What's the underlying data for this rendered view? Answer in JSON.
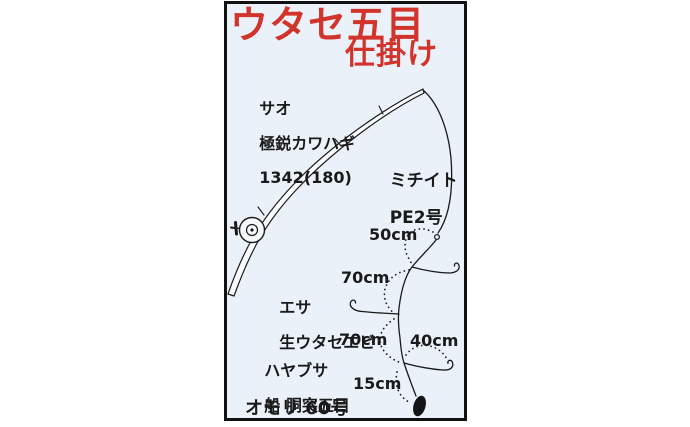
{
  "title": {
    "line1": "ウタセ五目",
    "line2": "仕掛け"
  },
  "rod_label": [
    "サオ",
    "極鋭カワハギ",
    "1342(180)"
  ],
  "line_label": [
    "ミチイト",
    "PE2号"
  ],
  "bait_label": [
    "エサ",
    "生ウタセエビ"
  ],
  "hook_label": [
    "ハヤブサ",
    "船 胴突五目"
  ],
  "sinker_label": "オモリ 60号",
  "measurements": {
    "m50": "50cm",
    "m70a": "70cm",
    "m70b": "70cm",
    "m40": "40cm",
    "m15": "15cm"
  },
  "colors": {
    "panel_bg": "#eaf1f8",
    "panel_border": "#111111",
    "ink": "#1a1a1a",
    "title_red": "#d2342c"
  }
}
